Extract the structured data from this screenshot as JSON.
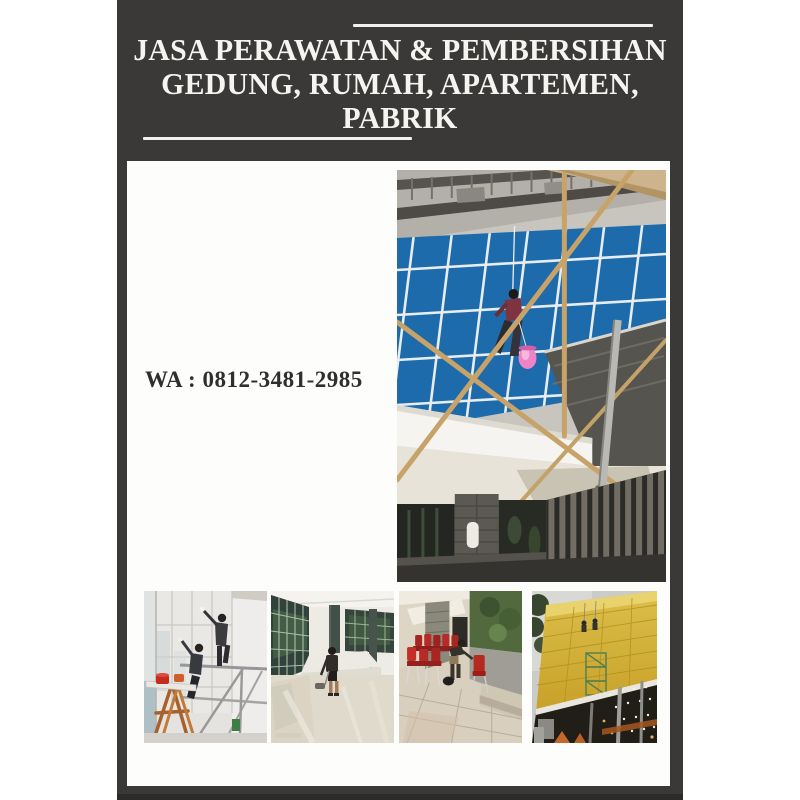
{
  "poster": {
    "title_lines": [
      "JASA PERAWATAN & PEMBERSIHAN",
      "GEDUNG, RUMAH, APARTEMEN,",
      "PABRIK"
    ],
    "contact": "WA : 0812-3481-2985",
    "colors": {
      "page-bg": "#ffffff",
      "poster-bg": "#3a3938",
      "poster-bg-deep": "#2c2b2a",
      "panel-bg": "#fdfdfc",
      "title-color": "#f5f4f1",
      "deco-line-color": "#f2f1ee",
      "contact-color": "#302f2e",
      "glass-blue": "#1e6bac",
      "facade-gold": "#d3ae35",
      "chair-red": "#b62b25",
      "bucket-pink": "#ef83c5"
    },
    "photos": [
      {
        "name": "facade-glass-cleaning",
        "description": "Worker rappelling down a blue glass building facade with bamboo scaffolding and a pink bucket"
      },
      {
        "name": "interior-glass-partition-cleaning",
        "description": "Two workers on scaffolding cleaning tall interior glass walls, wooden trestle and red buckets"
      },
      {
        "name": "marble-floor-polishing",
        "description": "Worker polishing a glossy marble floor in a large hall with dark framed windows"
      },
      {
        "name": "chair-cleaning-terrace",
        "description": "Worker cleaning rows of red upholstered chairs on a tiled building terrace"
      },
      {
        "name": "gold-facade-cleaning",
        "description": "Workers on ropes and a green scaffold tower cleaning a gold panelled facade"
      }
    ]
  }
}
